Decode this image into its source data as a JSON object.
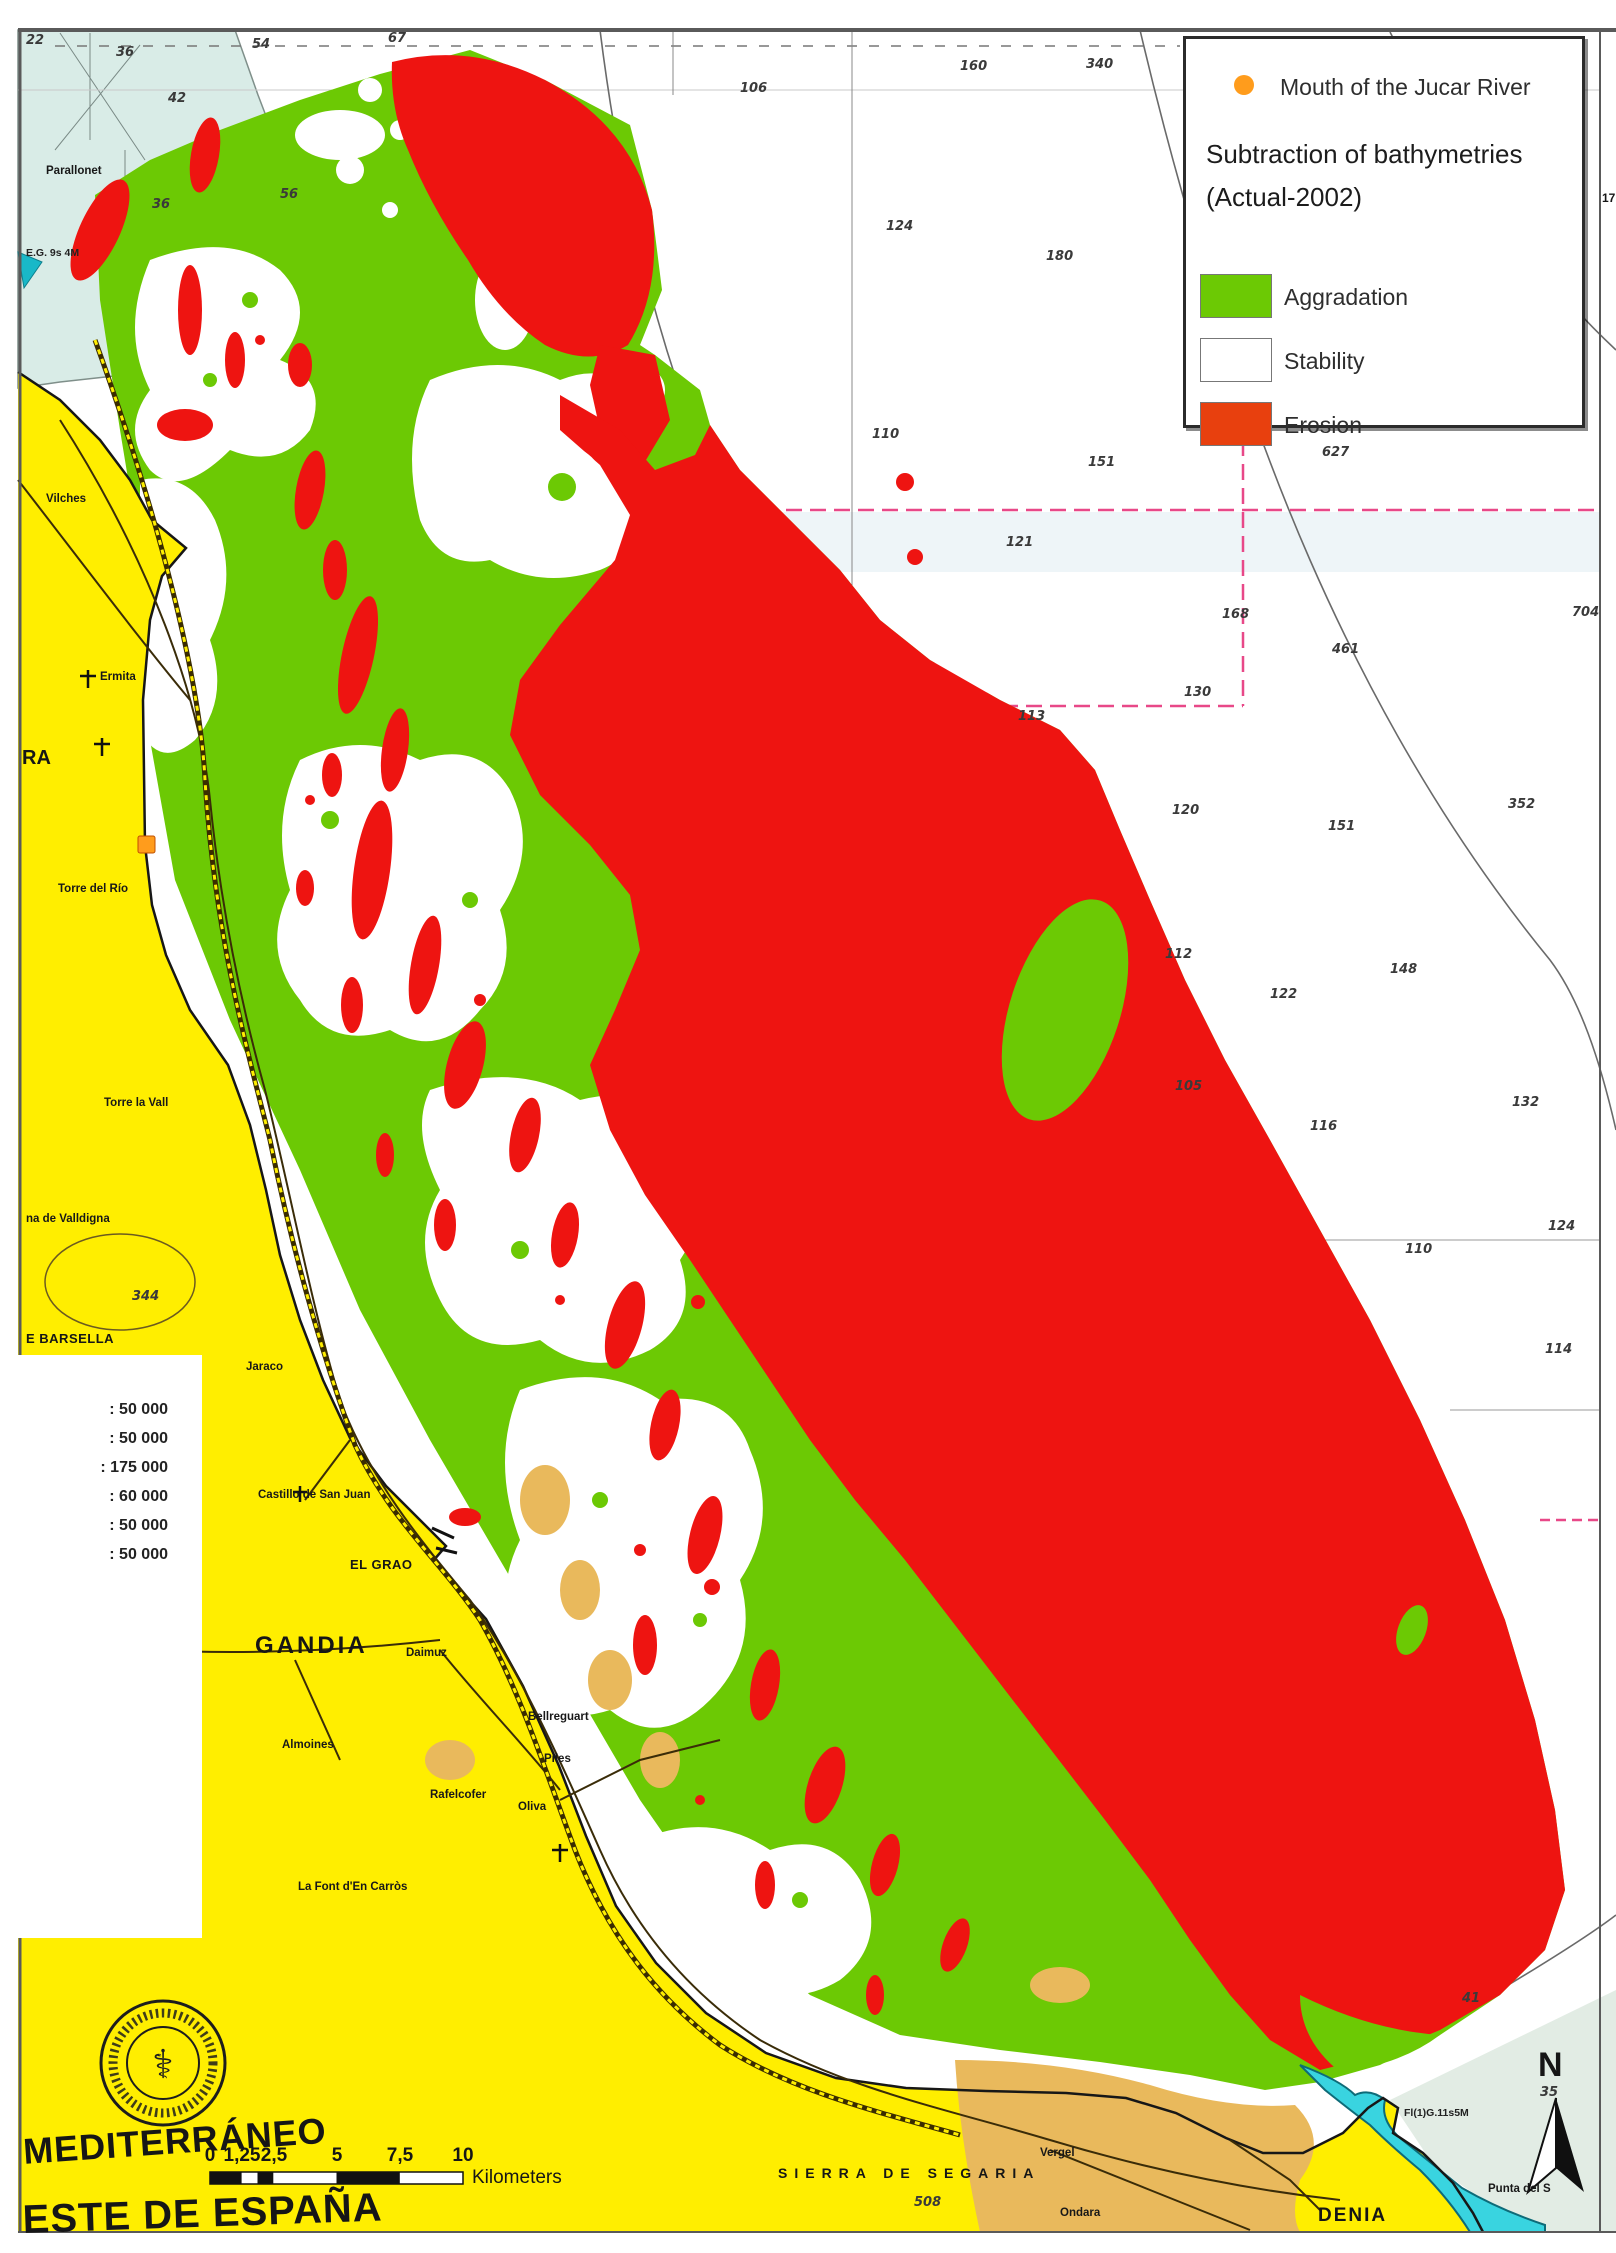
{
  "colors": {
    "aggradation": "#6cc904",
    "stability": "#ffffff",
    "erosion_map": "#ee1411",
    "erosion_legend": "#e8400e",
    "land": "#ffee00",
    "land_tan": "#e9b95c",
    "shallow": "#d9ece7",
    "harbor": "#39d4e0",
    "grid_pink": "#e84888",
    "marker_orange": "#ff9c1c",
    "contour_gray": "#6a6a6a",
    "road_brown": "#3a2c08"
  },
  "legend": {
    "marker_label": "Mouth of the Jucar River",
    "title_line1": "Subtraction of bathymetries",
    "title_line2": "(Actual-2002)",
    "items": [
      {
        "label": "Aggradation",
        "color": "#6cc904"
      },
      {
        "label": "Stability",
        "color": "#ffffff"
      },
      {
        "label": "Erosion",
        "color": "#e8400e"
      }
    ]
  },
  "inset_panel": {
    "rows": [
      ": 50 000",
      ": 50 000",
      ": 175 000",
      ": 60 000",
      ": 50 000",
      ": 50 000"
    ]
  },
  "map": {
    "soundings": [
      {
        "x": 26,
        "y": 34,
        "v": "22"
      },
      {
        "x": 116,
        "y": 46,
        "v": "36"
      },
      {
        "x": 252,
        "y": 38,
        "v": "54"
      },
      {
        "x": 388,
        "y": 32,
        "v": "67"
      },
      {
        "x": 168,
        "y": 92,
        "v": "42"
      },
      {
        "x": 152,
        "y": 198,
        "v": "36"
      },
      {
        "x": 280,
        "y": 188,
        "v": "56"
      },
      {
        "x": 740,
        "y": 82,
        "v": "106"
      },
      {
        "x": 960,
        "y": 60,
        "v": "160"
      },
      {
        "x": 1086,
        "y": 58,
        "v": "340"
      },
      {
        "x": 886,
        "y": 220,
        "v": "124"
      },
      {
        "x": 1046,
        "y": 250,
        "v": "180"
      },
      {
        "x": 872,
        "y": 428,
        "v": "110"
      },
      {
        "x": 1088,
        "y": 456,
        "v": "151"
      },
      {
        "x": 1322,
        "y": 446,
        "v": "627"
      },
      {
        "x": 1006,
        "y": 536,
        "v": "121"
      },
      {
        "x": 1222,
        "y": 608,
        "v": "168"
      },
      {
        "x": 1572,
        "y": 606,
        "v": "704"
      },
      {
        "x": 1332,
        "y": 643,
        "v": "461"
      },
      {
        "x": 1184,
        "y": 686,
        "v": "130"
      },
      {
        "x": 1018,
        "y": 710,
        "v": "113"
      },
      {
        "x": 1172,
        "y": 804,
        "v": "120"
      },
      {
        "x": 1328,
        "y": 820,
        "v": "151"
      },
      {
        "x": 1508,
        "y": 798,
        "v": "352"
      },
      {
        "x": 1165,
        "y": 948,
        "v": "112"
      },
      {
        "x": 1390,
        "y": 963,
        "v": "148"
      },
      {
        "x": 1270,
        "y": 988,
        "v": "122"
      },
      {
        "x": 1175,
        "y": 1080,
        "v": "105"
      },
      {
        "x": 1512,
        "y": 1096,
        "v": "132"
      },
      {
        "x": 1310,
        "y": 1120,
        "v": "116"
      },
      {
        "x": 1548,
        "y": 1220,
        "v": "124"
      },
      {
        "x": 1405,
        "y": 1243,
        "v": "110"
      },
      {
        "x": 1545,
        "y": 1343,
        "v": "114"
      },
      {
        "x": 132,
        "y": 1290,
        "v": "344"
      },
      {
        "x": 914,
        "y": 2196,
        "v": "508"
      },
      {
        "x": 1462,
        "y": 1992,
        "v": "41"
      },
      {
        "x": 1540,
        "y": 2086,
        "v": "35"
      }
    ],
    "labels": [
      {
        "t": "Parallonet",
        "x": 46,
        "y": 166,
        "cls": "tiny",
        "n": "label-parallonet"
      },
      {
        "t": "E.G. 9s 4M",
        "x": 26,
        "y": 248,
        "cls": "lightchar",
        "n": "label-light-characteristic"
      },
      {
        "t": "Vilches",
        "x": 46,
        "y": 494,
        "cls": "tiny",
        "n": "label-vilches"
      },
      {
        "t": "Ermita",
        "x": 100,
        "y": 672,
        "cls": "tiny",
        "n": "label-ermita"
      },
      {
        "t": "RA",
        "x": 22,
        "y": 748,
        "cls": "big-part",
        "n": "label-cullera-part"
      },
      {
        "t": "Torre del Río",
        "x": 58,
        "y": 884,
        "cls": "tiny",
        "n": "label-torre-del-rio"
      },
      {
        "t": "Torre la Vall",
        "x": 104,
        "y": 1098,
        "cls": "tiny",
        "n": "label-torre-la-vall"
      },
      {
        "t": "na de Valldigna",
        "x": 26,
        "y": 1214,
        "cls": "tiny",
        "n": "label-valldigna"
      },
      {
        "t": "E BARSELLA",
        "x": 26,
        "y": 1332,
        "cls": "small",
        "n": "label-barsella"
      },
      {
        "t": "Jaraco",
        "x": 246,
        "y": 1362,
        "cls": "tiny",
        "n": "label-jaraco"
      },
      {
        "t": "Castillo de  San Juan",
        "x": 258,
        "y": 1490,
        "cls": "tiny",
        "n": "label-castillo-san-juan"
      },
      {
        "t": "EL GRAO",
        "x": 350,
        "y": 1558,
        "cls": "small",
        "n": "label-el-grao"
      },
      {
        "t": "GANDIA",
        "x": 255,
        "y": 1634,
        "cls": "city",
        "n": "label-gandia"
      },
      {
        "t": "Daimuz",
        "x": 406,
        "y": 1648,
        "cls": "tiny",
        "n": "label-daimuz"
      },
      {
        "t": "Bellreguart",
        "x": 528,
        "y": 1712,
        "cls": "tiny",
        "n": "label-bellreguart"
      },
      {
        "t": "Almoines",
        "x": 282,
        "y": 1740,
        "cls": "tiny",
        "n": "label-almoines"
      },
      {
        "t": "Piles",
        "x": 544,
        "y": 1754,
        "cls": "tiny",
        "n": "label-piles"
      },
      {
        "t": "Rafelcofer",
        "x": 430,
        "y": 1790,
        "cls": "tiny",
        "n": "label-rafelcofer"
      },
      {
        "t": "Oliva",
        "x": 518,
        "y": 1802,
        "cls": "tiny",
        "n": "label-oliva"
      },
      {
        "t": "La Font d'En Carròs",
        "x": 298,
        "y": 1882,
        "cls": "tiny",
        "n": "label-font-den-carros"
      },
      {
        "t": "SIERRA DE SEGARIA",
        "x": 778,
        "y": 2166,
        "cls": "ridge",
        "n": "label-sierra-de-segaria"
      },
      {
        "t": "Vergel",
        "x": 1040,
        "y": 2148,
        "cls": "tiny",
        "n": "label-vergel"
      },
      {
        "t": "Ondara",
        "x": 1060,
        "y": 2208,
        "cls": "tiny",
        "n": "label-ondara"
      },
      {
        "t": "DENIA",
        "x": 1318,
        "y": 2206,
        "cls": "city2",
        "n": "label-denia"
      },
      {
        "t": "Punta del S",
        "x": 1488,
        "y": 2184,
        "cls": "tiny",
        "n": "label-punta-del-s"
      },
      {
        "t": "Fl(1)G.11s5M",
        "x": 1404,
        "y": 2108,
        "cls": "lightchar",
        "n": "label-denia-light"
      },
      {
        "t": "200",
        "x": 1296,
        "y": 326,
        "cls": "tiny",
        "r": 72,
        "n": "label-contour-200"
      },
      {
        "t": "17",
        "x": 1602,
        "y": 192,
        "cls": "deg",
        "n": "tick-17"
      },
      {
        "t": "42'",
        "x": 162,
        "y": 1572,
        "cls": "deg",
        "n": "tick-42min"
      },
      {
        "t": "20'",
        "x": 170,
        "y": 1684,
        "cls": "deg",
        "n": "tick-20min"
      },
      {
        "t": "39°",
        "x": 166,
        "y": 1786,
        "cls": "deg",
        "n": "tick-39deg"
      },
      {
        "t": "20'",
        "x": 82,
        "y": 1908,
        "cls": "deg",
        "n": "tick-20min-b"
      },
      {
        "t": "40'",
        "x": 164,
        "y": 1908,
        "cls": "deg",
        "n": "tick-40min"
      },
      {
        "t": "0",
        "x": 210,
        "y": 2146,
        "cls": "sbtick",
        "n": "scalebar-tick-0"
      },
      {
        "t": "1,25",
        "x": 242,
        "y": 2146,
        "cls": "sbtick",
        "n": "scalebar-tick-1-25"
      },
      {
        "t": "2,5",
        "x": 274,
        "y": 2146,
        "cls": "sbtick",
        "n": "scalebar-tick-2-5"
      },
      {
        "t": "5",
        "x": 337,
        "y": 2146,
        "cls": "sbtick",
        "n": "scalebar-tick-5"
      },
      {
        "t": "7,5",
        "x": 400,
        "y": 2146,
        "cls": "sbtick",
        "n": "scalebar-tick-7-5"
      },
      {
        "t": "10",
        "x": 463,
        "y": 2146,
        "cls": "sbtick",
        "n": "scalebar-tick-10"
      },
      {
        "t": "Kilometers",
        "x": 472,
        "y": 2168,
        "cls": "km",
        "n": "scalebar-unit"
      },
      {
        "t": "MEDITERRÁNEO",
        "x": 22,
        "y": 2134,
        "cls": "sea-name",
        "r": -4,
        "n": "label-mediterraneo"
      },
      {
        "t": "ESTE DE ESPAÑA",
        "x": 22,
        "y": 2200,
        "cls": "sea-name2",
        "r": -2,
        "n": "label-este-de-espana"
      },
      {
        "t": "N",
        "x": 1538,
        "y": 2048,
        "cls": "north",
        "n": "north-letter"
      }
    ]
  }
}
